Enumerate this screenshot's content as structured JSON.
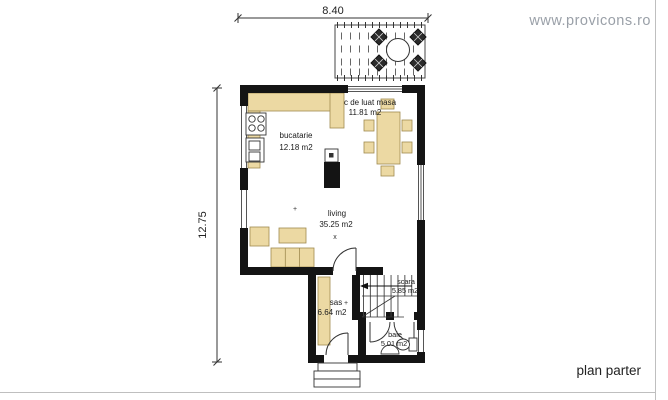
{
  "header": {
    "website": "www.provicons.ro"
  },
  "footer": {
    "plan_label": "plan parter"
  },
  "dimensions": {
    "top_width": "8.40",
    "left_height": "12.75"
  },
  "rooms": {
    "kitchen": {
      "name": "bucatarie",
      "area": "12.18 m2"
    },
    "dining": {
      "name": "c de luat masa",
      "area": "11.81 m2"
    },
    "living": {
      "name": "living",
      "area": "35.25 m2"
    },
    "sas": {
      "name": "sas",
      "area": "6.64 m2"
    },
    "stairs": {
      "name": "scara",
      "area": "5.85 m2"
    },
    "bath": {
      "name": "baie",
      "area": "5.01 m2"
    }
  },
  "markers": {
    "plus": "+",
    "cross": "x"
  },
  "colors": {
    "wall": "#141414",
    "furniture": "#ecd9a3",
    "furniture_outline": "#a08b4f",
    "line": "#333333",
    "page_border": "#bfbfbf",
    "website_text": "#9aa0a8"
  }
}
